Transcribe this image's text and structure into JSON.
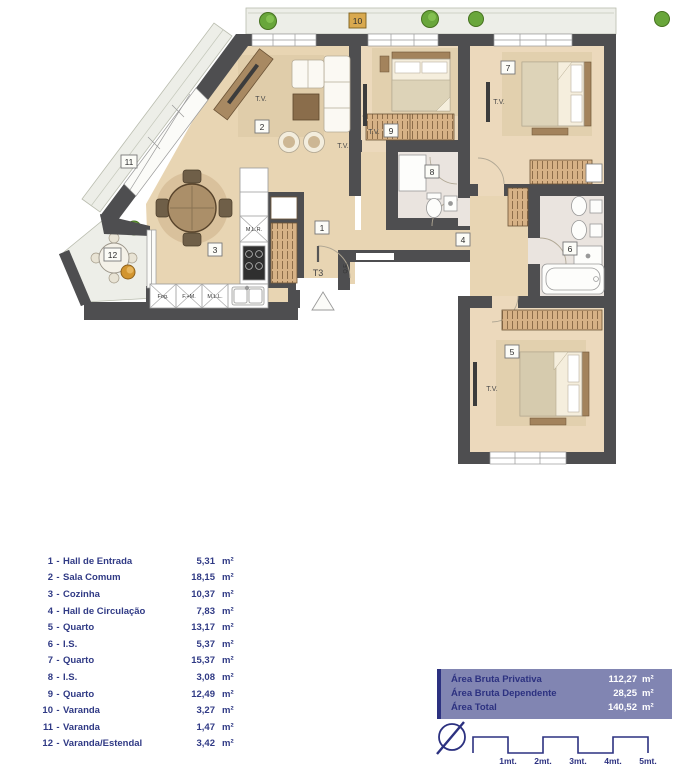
{
  "plan": {
    "type_label": "T3",
    "tv_label": "T.V.",
    "qe_label": "Q.E.",
    "appliances": {
      "mlr": "M.L.R.",
      "fog": "Fog.",
      "fm": "F.+M.",
      "mll": "M.L.L."
    },
    "colors": {
      "wall": "#4e4e50",
      "wood_floor": "#e8d5b3",
      "bath_floor": "#eae4df",
      "balcony_floor": "#edeee8",
      "accent_navy": "#2c3180",
      "summary_bg": "#8185b2",
      "plant_green": "#69a63b",
      "plant_orange": "#d29530"
    }
  },
  "legend": {
    "dash": "-",
    "unit": "m²",
    "rooms": [
      {
        "num": "1",
        "name": "Hall de Entrada",
        "area": "5,31"
      },
      {
        "num": "2",
        "name": "Sala Comum",
        "area": "18,15"
      },
      {
        "num": "3",
        "name": "Cozinha",
        "area": "10,37"
      },
      {
        "num": "4",
        "name": "Hall de Circulação",
        "area": "7,83"
      },
      {
        "num": "5",
        "name": "Quarto",
        "area": "13,17"
      },
      {
        "num": "6",
        "name": "I.S.",
        "area": "5,37"
      },
      {
        "num": "7",
        "name": "Quarto",
        "area": "15,37"
      },
      {
        "num": "8",
        "name": "I.S.",
        "area": "3,08"
      },
      {
        "num": "9",
        "name": "Quarto",
        "area": "12,49"
      },
      {
        "num": "10",
        "name": "Varanda",
        "area": "3,27"
      },
      {
        "num": "11",
        "name": "Varanda",
        "area": "1,47"
      },
      {
        "num": "12",
        "name": "Varanda/Estendal",
        "area": "3,42"
      }
    ]
  },
  "summary": {
    "unit": "m²",
    "rows": [
      {
        "label": "Área Bruta Privativa",
        "value": "112,27"
      },
      {
        "label": "Área Bruta Dependente",
        "value": "28,25"
      },
      {
        "label": "Área Total",
        "value": "140,52"
      }
    ]
  },
  "scale": {
    "labels": [
      "1mt.",
      "2mt.",
      "3mt.",
      "4mt.",
      "5mt."
    ]
  }
}
